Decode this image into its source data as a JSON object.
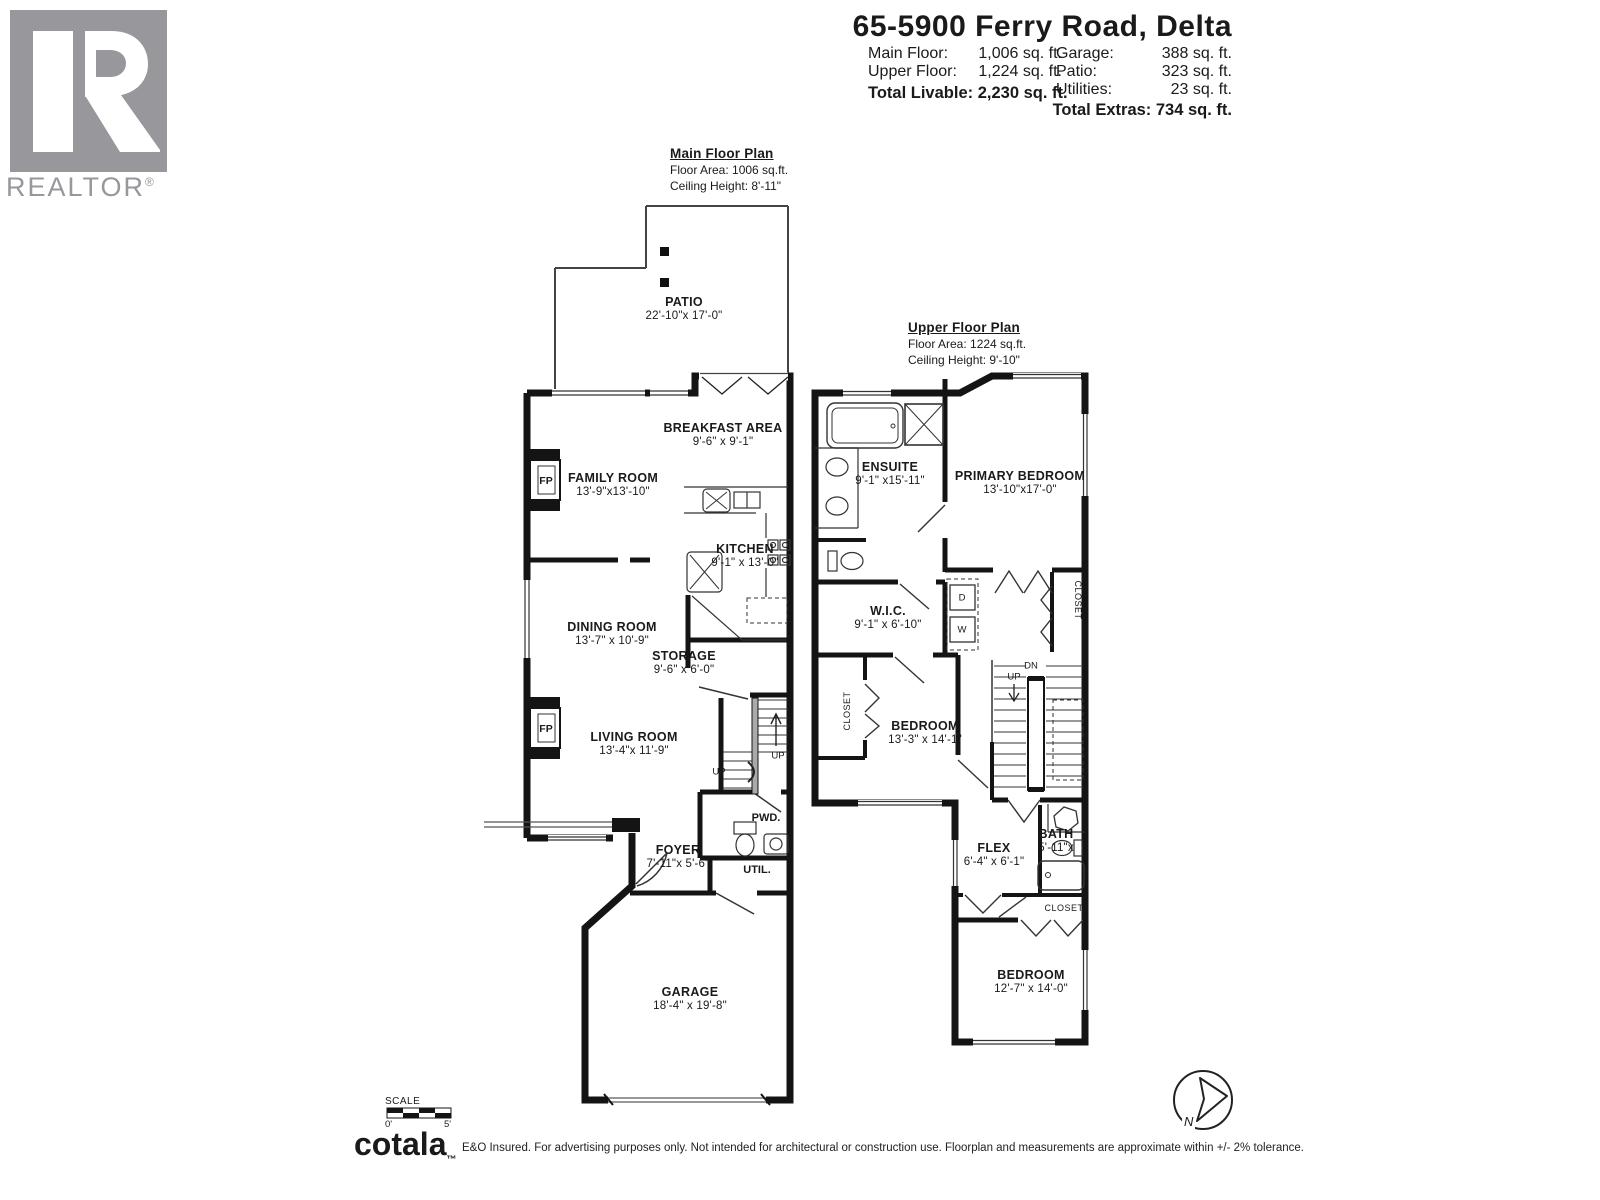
{
  "header": {
    "title": "65-5900 Ferry Road, Delta",
    "stats_left": [
      {
        "label": "Main Floor:",
        "value": "1,006 sq. ft."
      },
      {
        "label": "Upper Floor:",
        "value": "1,224 sq. ft."
      }
    ],
    "total_livable": "Total Livable: 2,230 sq. ft.",
    "stats_right": [
      {
        "label": "Garage:",
        "value": "388 sq. ft."
      },
      {
        "label": "Patio:",
        "value": "323 sq. ft."
      },
      {
        "label": "Utilities:",
        "value": "23 sq. ft."
      }
    ],
    "total_extras": "Total Extras: 734 sq. ft."
  },
  "branding": {
    "realtor_text": "REALTOR",
    "realtor_reg": "®",
    "realtor_logo_color": "#97979c",
    "cotala": "cotala",
    "cotala_tm": "™",
    "disclaimer": "E&O Insured. For advertising purposes only. Not intended for architectural or construction use. Floorplan and measurements are approximate within +/- 2% tolerance."
  },
  "scale_bar": {
    "label": "SCALE",
    "start": "0'",
    "end": "5'"
  },
  "compass": {
    "north": "N"
  },
  "main_floor": {
    "title": "Main Floor Plan",
    "floor_area": "Floor Area: 1006 sq.ft.",
    "ceiling_height": "Ceiling Height: 8'-11\"",
    "rooms": {
      "patio": {
        "name": "PATIO",
        "dims": "22'-10\"x 17'-0\""
      },
      "breakfast": {
        "name": "BREAKFAST AREA",
        "dims": "9'-6\" x 9'-1\""
      },
      "family": {
        "name": "FAMILY ROOM",
        "dims": "13'-9\"x13'-10\""
      },
      "kitchen": {
        "name": "KITCHEN",
        "dims": "9'-1\" x 13'-0\""
      },
      "dining": {
        "name": "DINING ROOM",
        "dims": "13'-7\" x 10'-9\""
      },
      "storage": {
        "name": "STORAGE",
        "dims": "9'-6\" x 6'-0\""
      },
      "living": {
        "name": "LIVING ROOM",
        "dims": "13'-4\"x 11'-9\""
      },
      "pwd": {
        "name": "PWD."
      },
      "util": {
        "name": "UTIL."
      },
      "foyer": {
        "name": "FOYER",
        "dims": "7'-11\"x 5'-6\""
      },
      "garage": {
        "name": "GARAGE",
        "dims": "18'-4\" x 19'-8\""
      }
    },
    "labels": {
      "fp": "FP",
      "up": "UP"
    }
  },
  "upper_floor": {
    "title": "Upper Floor Plan",
    "floor_area": "Floor Area: 1224 sq.ft.",
    "ceiling_height": "Ceiling Height: 9'-10\"",
    "rooms": {
      "ensuite": {
        "name": "ENSUITE",
        "dims": "9'-1\" x15'-11\""
      },
      "primary_bedroom": {
        "name": "PRIMARY BEDROOM",
        "dims": "13'-10\"x17'-0\""
      },
      "wic": {
        "name": "W.I.C.",
        "dims": "9'-1\" x 6'-10\""
      },
      "bedroom_2": {
        "name": "BEDROOM",
        "dims": "13'-3\" x 14'-1\""
      },
      "flex": {
        "name": "FLEX",
        "dims": "6'-4\" x 6'-1\""
      },
      "bath": {
        "name": "BATH",
        "dims": "5'-11\"x"
      },
      "bedroom_3": {
        "name": "BEDROOM",
        "dims": "12'-7\" x 14'-0\""
      }
    },
    "labels": {
      "dn": "DN",
      "up": "UP",
      "dryer": "D",
      "washer": "W",
      "closet": "CLOSET"
    }
  }
}
